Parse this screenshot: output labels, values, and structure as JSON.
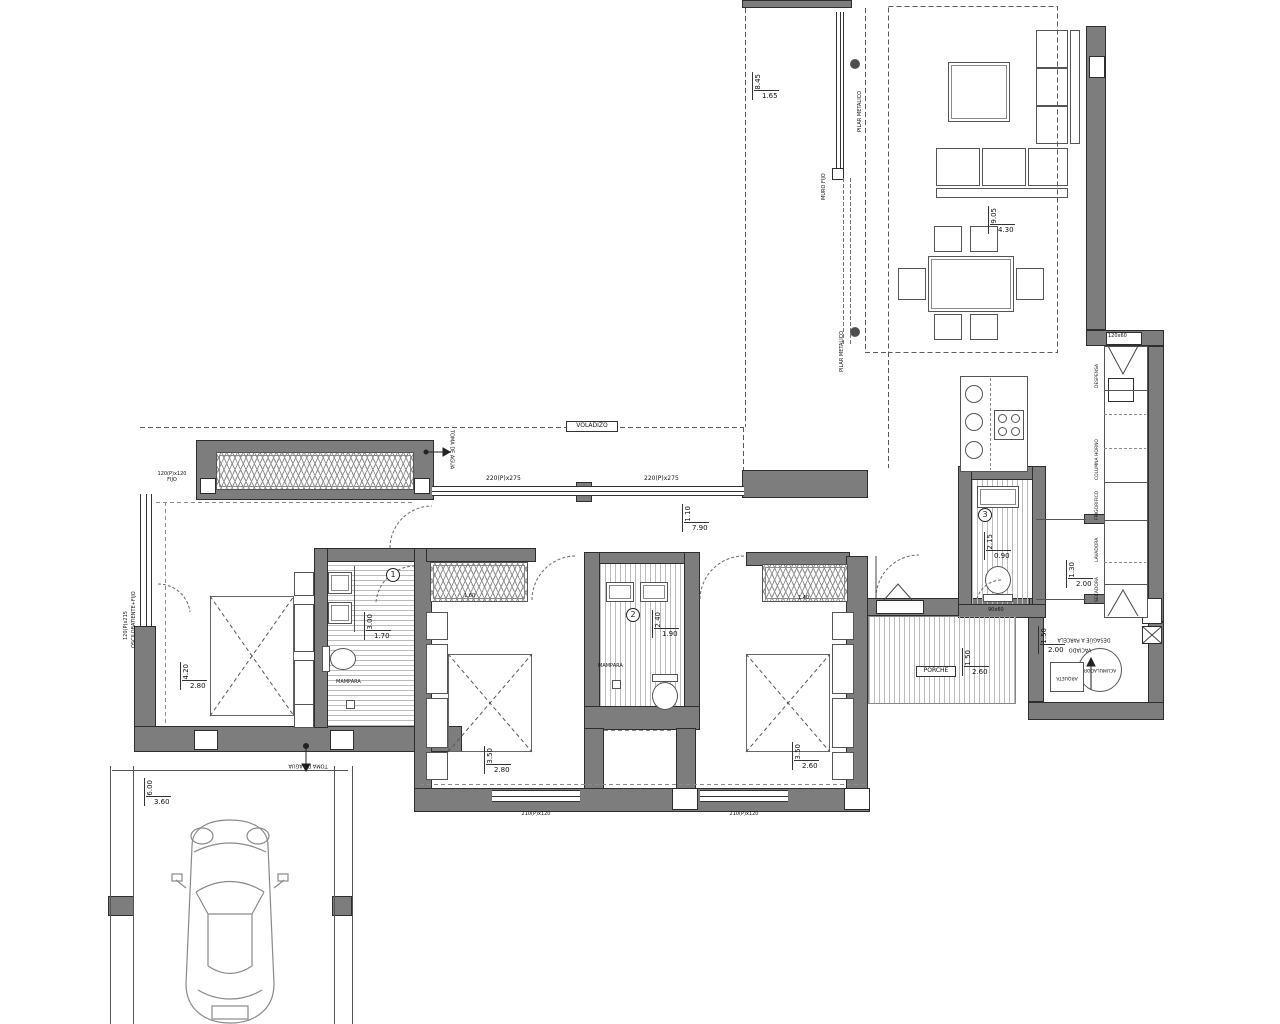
{
  "meta": {
    "kind": "architectural floor plan",
    "language": "es"
  },
  "ann": {
    "voladizo": "VOLADIZO",
    "porche": "PORCHE",
    "toma_hall": "TOMA DE AGUA",
    "toma_garage": "TOMA DE AGUA",
    "pilar_top": "PILAR METALICO",
    "pilar_bottom": "PILAR METALICO",
    "muro_fijo": "MURO FIJO",
    "mampara1": "MAMPARA",
    "mampara2": "MAMPARA",
    "desague": "DESAGÜE A PARCELA",
    "vaciado": "VACIADO",
    "acumulador": "ACUMULADOR",
    "arqueta": "ARQUETA"
  },
  "win": {
    "hall1": "220(P)x275",
    "hall2": "220(P)x275",
    "bed1_fixed_size": "120(P)x120",
    "bed1_fixed_type": "FIJO",
    "bed1_side_size": "120(P)x215",
    "bed1_side_type": "OSCILOBATIENTE+FIJO",
    "bed2": "210(P)x120",
    "bed3": "210(P)x120",
    "pillar_tr": "120x60",
    "pillar_b3": "90x60"
  },
  "cab": {
    "c1": "DESPENSA",
    "c2": "COLUMNA HORNO",
    "c3": "FRIGORIFICO",
    "c4": "LAVADORA",
    "c5": "SECADORA"
  },
  "ward": {
    "bed2": "1.60",
    "bed3": "1.40"
  },
  "num": {
    "b1": "1",
    "b2": "2",
    "b3": "3"
  },
  "dims": {
    "terrace_side": {
      "v": "8.45",
      "h": "1.65"
    },
    "terrace_main": {
      "v": "9.05",
      "h": "4.30"
    },
    "hall": {
      "v": "1.10",
      "h": "7.90"
    },
    "bedroom1": {
      "v": "4.20",
      "h": "2.80"
    },
    "bath1": {
      "v": "3.00",
      "h": "1.70"
    },
    "bedroom2": {
      "v": "3.50",
      "h": "2.80"
    },
    "bath2": {
      "v": "2.40",
      "h": "1.90"
    },
    "bedroom3": {
      "v": "3.50",
      "h": "2.60"
    },
    "bath3": {
      "v": "2.15",
      "h": "0.90"
    },
    "porch": {
      "v": "1.50",
      "h": "2.60"
    },
    "hall_right": {
      "v": "1.30",
      "h": "2.00"
    },
    "utility": {
      "v": "1.50",
      "h": "2.00"
    },
    "garage": {
      "v": "6.00",
      "h": "3.60"
    }
  }
}
